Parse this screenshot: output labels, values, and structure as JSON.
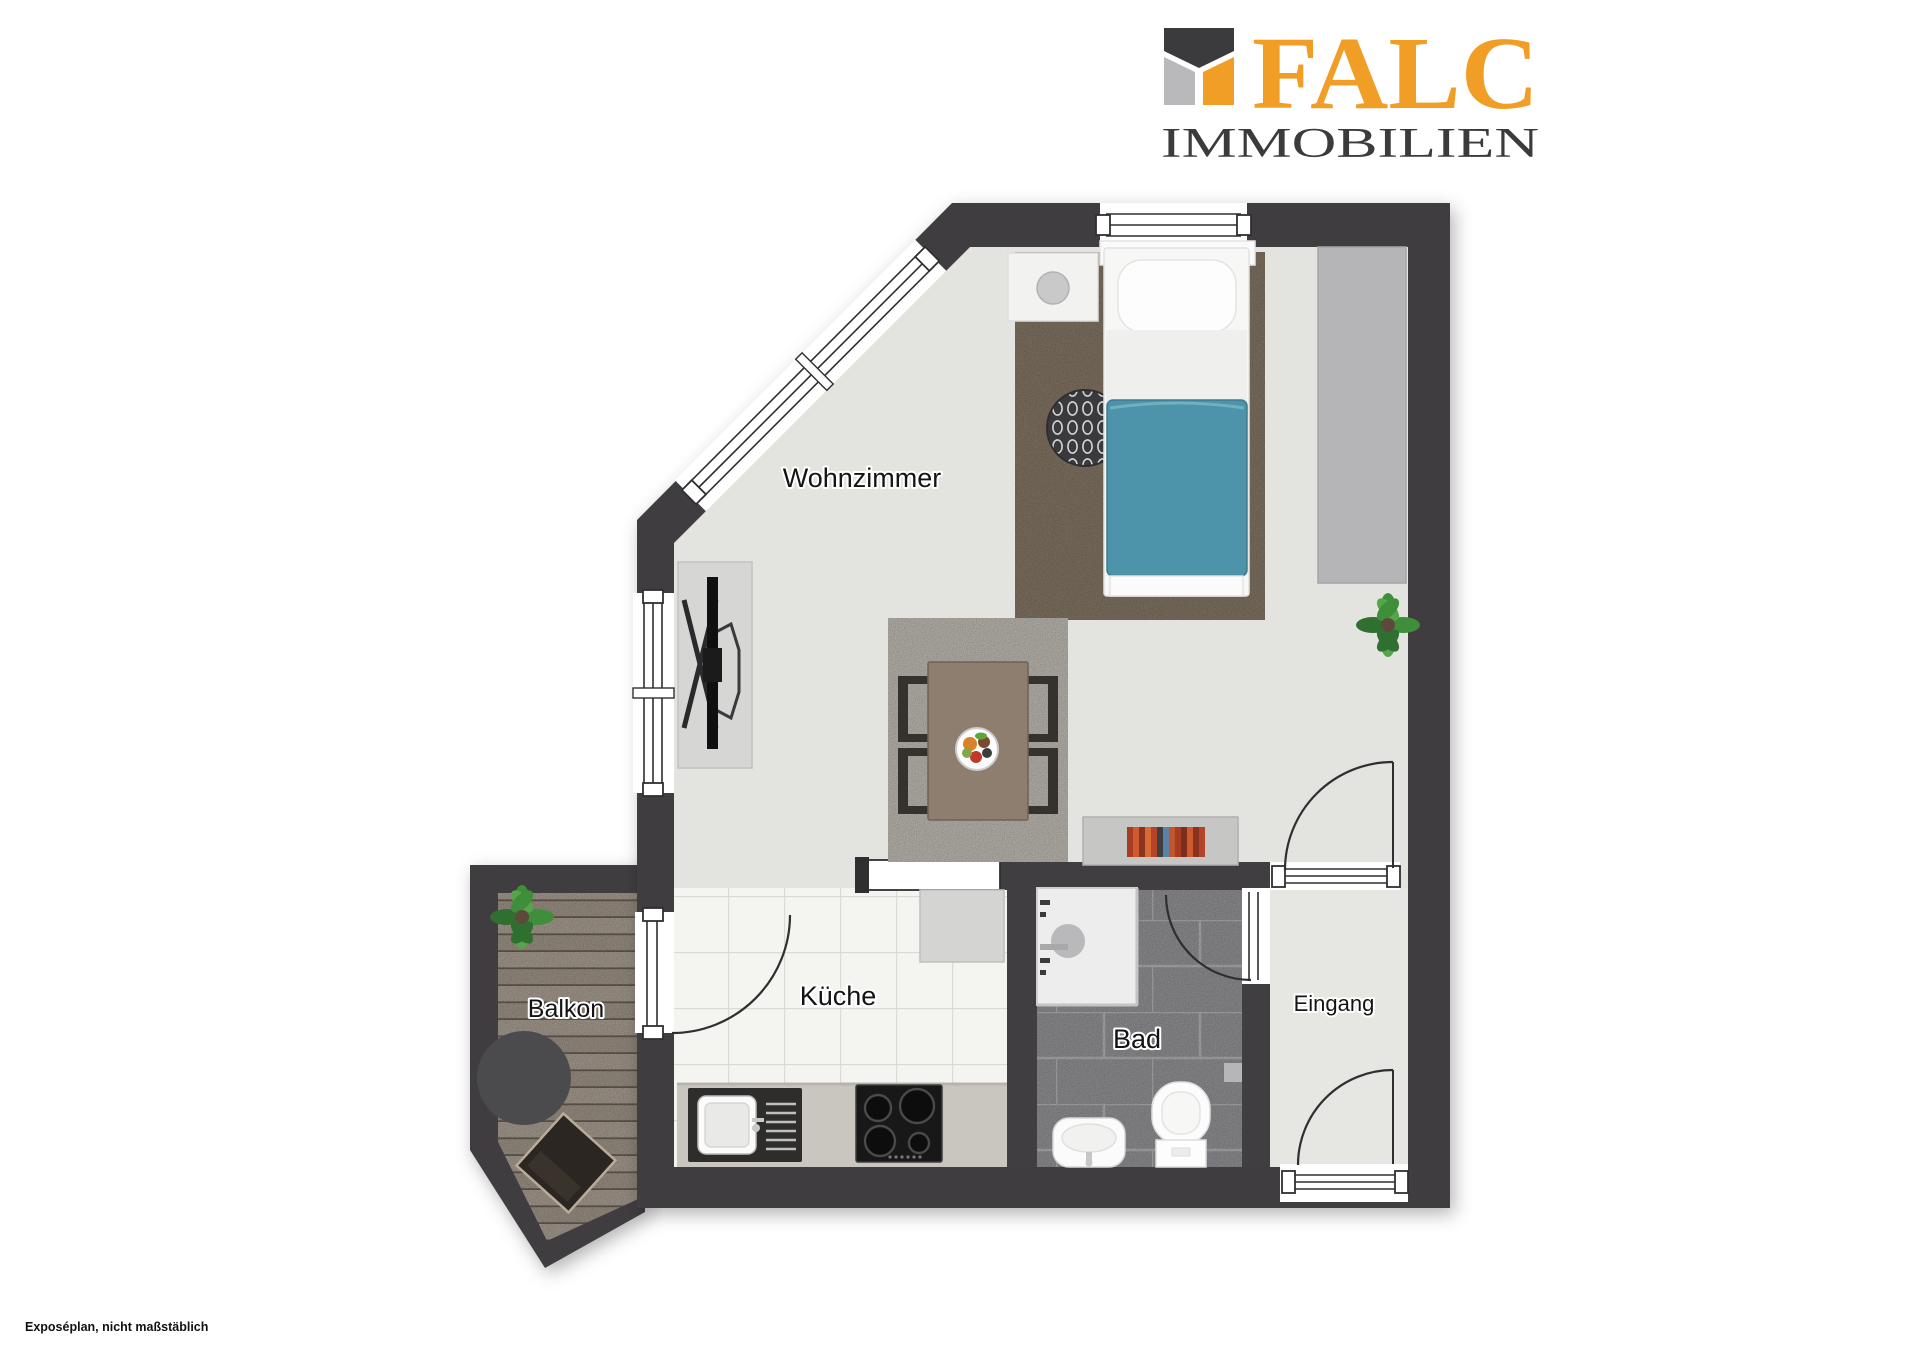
{
  "brand": {
    "name": "FALC",
    "subtitle": "IMMOBILIEN"
  },
  "rooms": {
    "living": "Wohnzimmer",
    "kitchen": "Küche",
    "bath": "Bad",
    "entry": "Eingang",
    "balcony": "Balkon"
  },
  "footnote": "Exposéplan, nicht maßstäblich",
  "colors": {
    "wall": "#403E41",
    "orange": "#F09E26",
    "logoDark": "#3B3B3D",
    "logoGray": "#B9B9BB",
    "floorLiving": "#E3E3DF",
    "floorEntry": "#E6E6E2",
    "kitchenTile": "#F4F4F1",
    "bathStone": "#9C9CA0",
    "balconyWood": "#B3A89C",
    "bedRug": "#8C7E6C",
    "diningRug": "#CBC7BE",
    "duvet": "#4D93A9",
    "counter": "#C9C6C0",
    "wardrobe": "#B5B5B7",
    "balconyTable": "#4B4B4D",
    "bookSpines": [
      "#A63C22",
      "#CF5A2E",
      "#8A3420",
      "#D96A35",
      "#5B82A6",
      "#B5432A",
      "#3F3F3F",
      "#C2562F"
    ]
  }
}
